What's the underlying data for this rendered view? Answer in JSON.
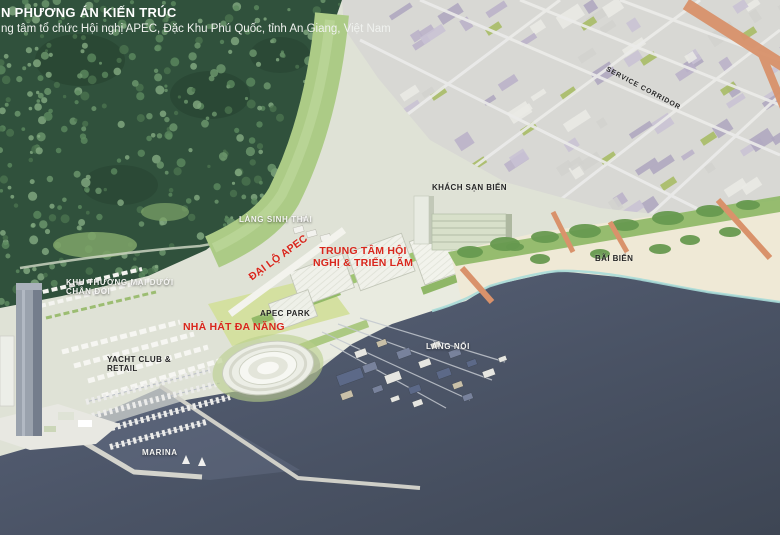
{
  "header": {
    "title_line1": "N PHƯƠNG ÁN KIẾN TRÚC",
    "title_line2": "ng tâm tổ chức Hội nghị APEC, Đặc Khu Phú Quốc, tỉnh An Giang, Việt Nam"
  },
  "labels": {
    "service_corridor": "SERVICE CORRIDOR",
    "khach_san_bien": "KHÁCH SẠN BIỂN",
    "lang_sinh_thai": "LÀNG SINH THÁI",
    "dai_lo_apec": "ĐẠI LỘ APEC",
    "trung_tam_hoi_nghi_line1": "TRUNG TÂM HỘI",
    "trung_tam_hoi_nghi_line2": "NGHỊ & TRIỂN LÃM",
    "bai_bien": "BÃI BIỂN",
    "khu_thuong_mai_line1": "KHU THƯƠNG MẠI DƯỚI",
    "khu_thuong_mai_line2": "CHÂN ĐỒI",
    "apec_park": "APEC PARK",
    "nha_hat_da_nang": "NHÀ HÁT ĐA NĂNG",
    "yacht_club_line1": "YACHT CLUB &",
    "yacht_club_line2": "RETAIL",
    "lang_noi": "LÀNG NỔI",
    "marina": "MARINA"
  },
  "colors": {
    "label_red": "#d9261c",
    "label_dark": "#262626",
    "label_white": "#f5f5f3",
    "forest_green": "#30513c",
    "water_dark": "#414a5b",
    "beach_sand": "#efe9d6",
    "salmon_road": "#d9926b",
    "city_lilac": "#b9b1c8"
  }
}
